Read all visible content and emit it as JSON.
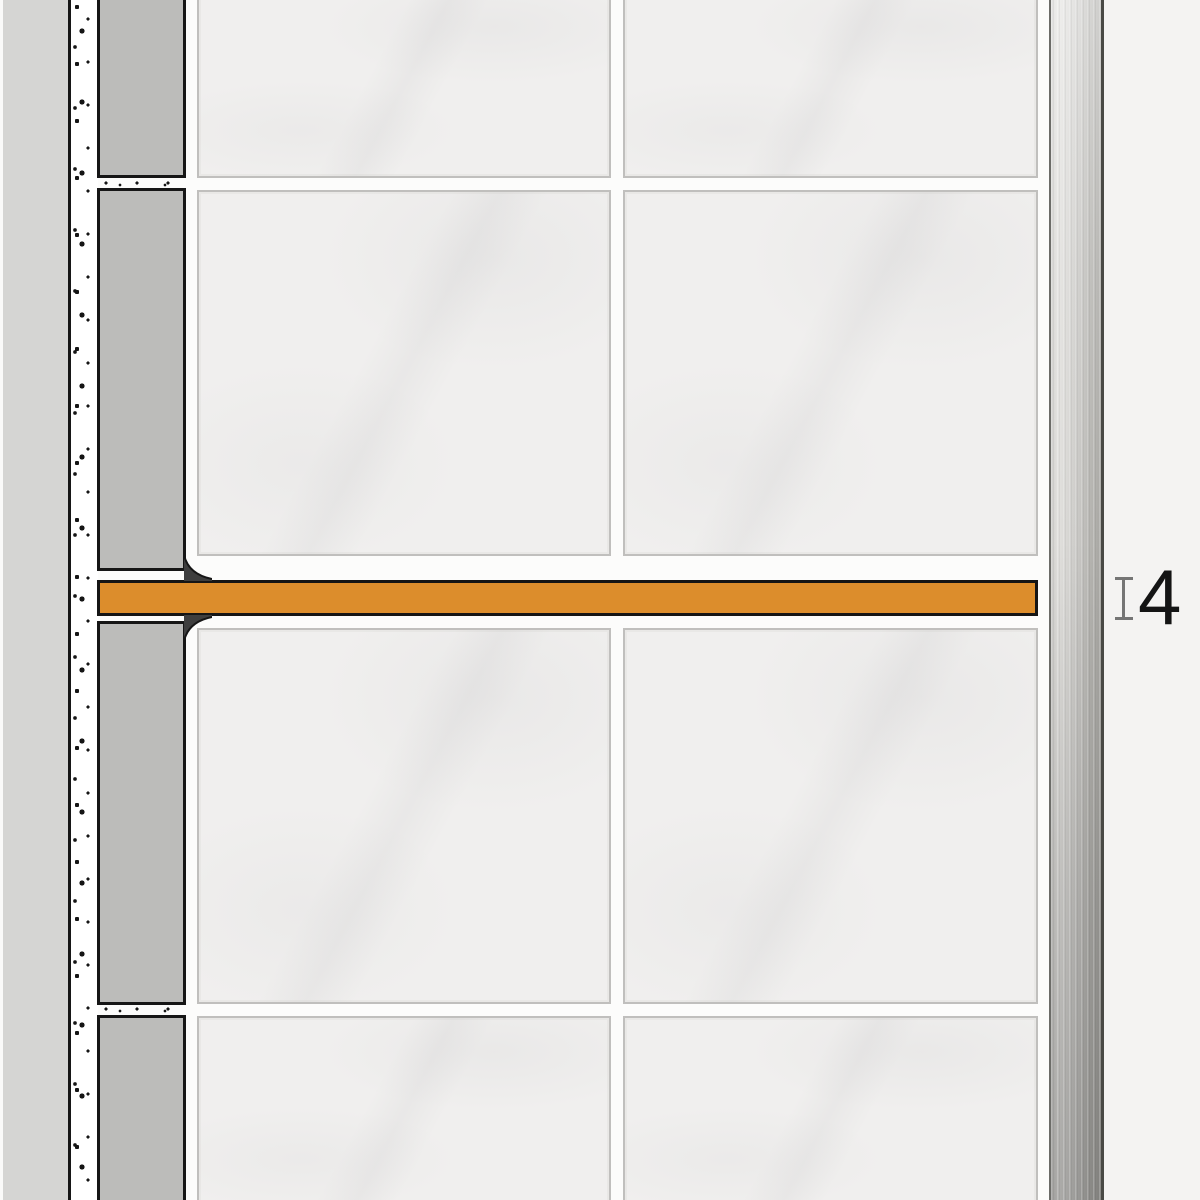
{
  "diagram": {
    "dimension": {
      "value": "4",
      "marker_icon": "thickness-extent-icon"
    },
    "colors": {
      "profile_orange": "#DC8D2C",
      "outline_black": "#161616",
      "tile_face": "#F0EFEE",
      "tile_border": "#C0BFBD",
      "grout_white": "#FCFCFB",
      "tile_section_gray": "#BCBCBA",
      "substrate_gray": "#D5D5D3",
      "mortar_speckle_bg": "#FFFFFF",
      "trim_metal_light": "#E2E1DE",
      "trim_metal_dark": "#A8A7A3",
      "background_right": "#F4F3F2",
      "dimension_marker_gray": "#757575",
      "dimension_text": "#141414"
    }
  }
}
